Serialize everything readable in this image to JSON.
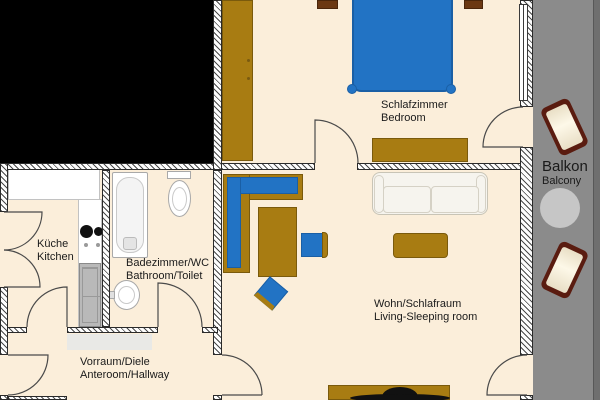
{
  "title": "Apartment floor plan",
  "rooms": {
    "bedroom": {
      "de": "Schlafzimmer",
      "en": "Bedroom"
    },
    "kitchen": {
      "de": "Küche",
      "en": "Kitchen"
    },
    "bathroom": {
      "de": "Badezimmer/WC",
      "en": "Bathroom/Toilet"
    },
    "living": {
      "de": "Wohn/Schlafraum",
      "en": "Living-Sleeping room"
    },
    "hallway": {
      "de": "Vorraum/Diele",
      "en": "Anteroom/Hallway"
    },
    "balcony": {
      "de": "Balkon",
      "en": "Balcony"
    }
  },
  "colors": {
    "floor": "#fbeeda",
    "outside": "#000000",
    "wood": "#a87c12",
    "wood_dark": "#6b3812",
    "blue": "#2273c4",
    "blue_border": "#1a5fa5",
    "balcony": "#8b8b8b",
    "railing": "#6f6f6f",
    "appliance": "#b9b9b9",
    "lounge_frame": "#5a1c10",
    "lounge_seat": "#e9dfc6",
    "table_round": "#c6c6c6",
    "sofa_white": "#f6f4ee",
    "text": "#1a1a1a"
  }
}
